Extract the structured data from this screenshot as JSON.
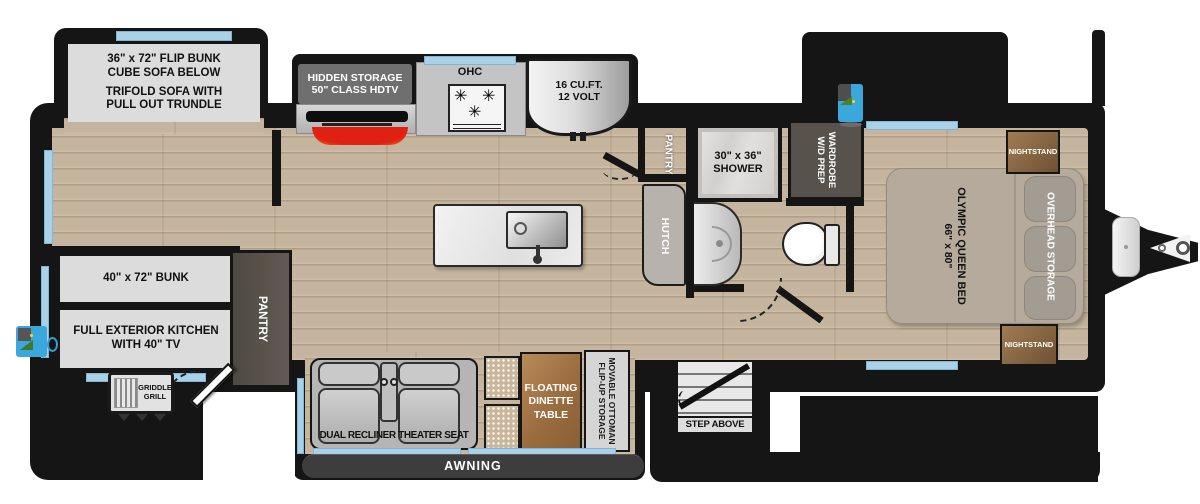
{
  "colors": {
    "wall_black": "#151515",
    "window_blue": "#a9d2e8",
    "floor_wood": "#c6b59e",
    "label_panel_grey": "#dcdcdc",
    "dark_cabinet_brown": "#57524b",
    "fireplace_red": "#e02010",
    "bed_tan": "#b5aa9c",
    "nightstand_brown": "#8a6743",
    "dinette_wood": "#a57747",
    "awning_grey": "#3d3d3d",
    "exterior_icon_blue": "#3aa7dd"
  },
  "rear_slide": {
    "flip_bunk_line1": "36\" x 72\" FLIP BUNK",
    "flip_bunk_line2": "CUBE SOFA BELOW",
    "trifold_line1": "TRIFOLD SOFA WITH",
    "trifold_line2": "PULL OUT TRUNDLE"
  },
  "kitchen": {
    "hidden_storage_line1": "HIDDEN STORAGE",
    "hidden_storage_line2": "50\" CLASS HDTV",
    "ohc": "OHC",
    "fridge_line1": "16 CU.FT.",
    "fridge_line2": "12 VOLT",
    "pantry": "PANTRY",
    "hutch": "HUTCH"
  },
  "bath": {
    "shower_line1": "30\" x 36\"",
    "shower_line2": "SHOWER",
    "wardrobe_line1": "WARDROBE",
    "wardrobe_line2": "W/D PREP"
  },
  "bedroom": {
    "bed_line1": "OLYMPIC QUEEN BED",
    "bed_line2": "66\" x 80\"",
    "overhead_storage": "OVERHEAD STORAGE",
    "nightstand_front": "NIGHTSTAND",
    "nightstand_rear": "NIGHTSTAND"
  },
  "bunk_room": {
    "bunk": "40\" x 72\" BUNK",
    "exterior_kitchen_line1": "FULL EXTERIOR KITCHEN",
    "exterior_kitchen_line2": "WITH 40\" TV",
    "pantry": "PANTRY"
  },
  "living": {
    "theater_seat": "DUAL RECLINER THEATER SEAT",
    "dinette_line1": "FLOATING",
    "dinette_line2": "DINETTE",
    "dinette_line3": "TABLE",
    "movable_ottoman_line1": "MOVABLE OTTOMAN",
    "movable_ottoman_line2": "FLIP-UP STORAGE"
  },
  "exterior": {
    "griddle_line1": "GRIDDLE",
    "griddle_line2": "GRILL",
    "awning": "AWNING",
    "step": "STEP ABOVE"
  }
}
